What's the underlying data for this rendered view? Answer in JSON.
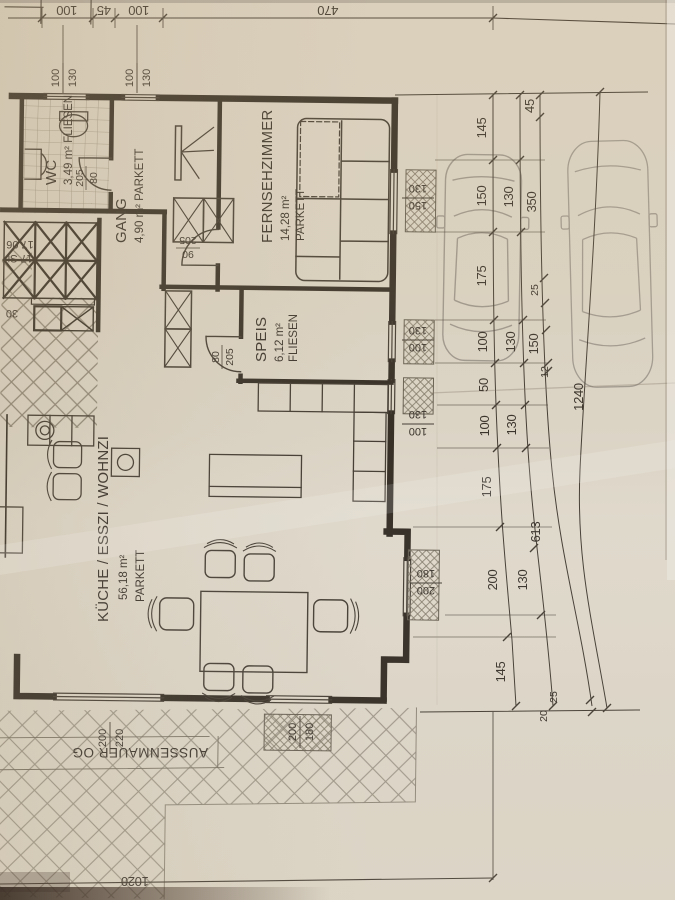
{
  "rooms": [
    {
      "name": "WC",
      "details": "3,49 m² FLIESEN"
    },
    {
      "name": "GANG",
      "details": "4,90 m² PARKETT"
    },
    {
      "name": "FERNSEHZIMMER",
      "area": "14,28 m²",
      "floor": "PARKETT"
    },
    {
      "name": "SPEIS",
      "area": "6,12 m²",
      "floor": "FLIESEN"
    },
    {
      "name": "KÜCHE / ESSZI / WOHNZI",
      "area": "56,18 m²",
      "floor": "PARKETT"
    }
  ],
  "stairs": {
    "line1": "17 St",
    "line2": "17,06",
    "tread": "30"
  },
  "wall_label": "AUSSENMAUER OG",
  "dims": {
    "top": [
      "100",
      "45",
      "100",
      "470"
    ],
    "chain_a": [
      "145",
      "150",
      "175",
      "100",
      "50",
      "100",
      "175",
      "200",
      "145"
    ],
    "chain_b": [
      "130",
      "130",
      "130",
      "130"
    ],
    "chain_c": [
      "45",
      "350",
      "25",
      "150",
      "12",
      "613"
    ],
    "chain_c_bottom": [
      "25",
      "20"
    ],
    "total": "1240",
    "bottom": "1020"
  },
  "window_markers": {
    "top1": {
      "left": "100",
      "right": "130"
    },
    "top2": {
      "left": "100",
      "right": "130"
    },
    "right1": {
      "top": "130",
      "bottom": "150"
    },
    "right2": {
      "top": "130",
      "bottom": "100"
    },
    "right3": {
      "top": "130",
      "bottom": "100"
    },
    "right4": {
      "top": "180",
      "bottom": "200"
    },
    "bottom1": {
      "left": "200",
      "right": "180"
    },
    "bottom2": {
      "left": "200",
      "right": "220"
    }
  },
  "door_labels": {
    "wc": {
      "left": "205",
      "right": "80"
    },
    "gang": {
      "top": "205",
      "bottom": "90"
    },
    "speis": {
      "left": "80",
      "right": "205"
    }
  },
  "colors": {
    "ink": "#29231b",
    "paper": "#ded7c9",
    "car_line": "#9a948b",
    "hatch": "#8d8678"
  }
}
